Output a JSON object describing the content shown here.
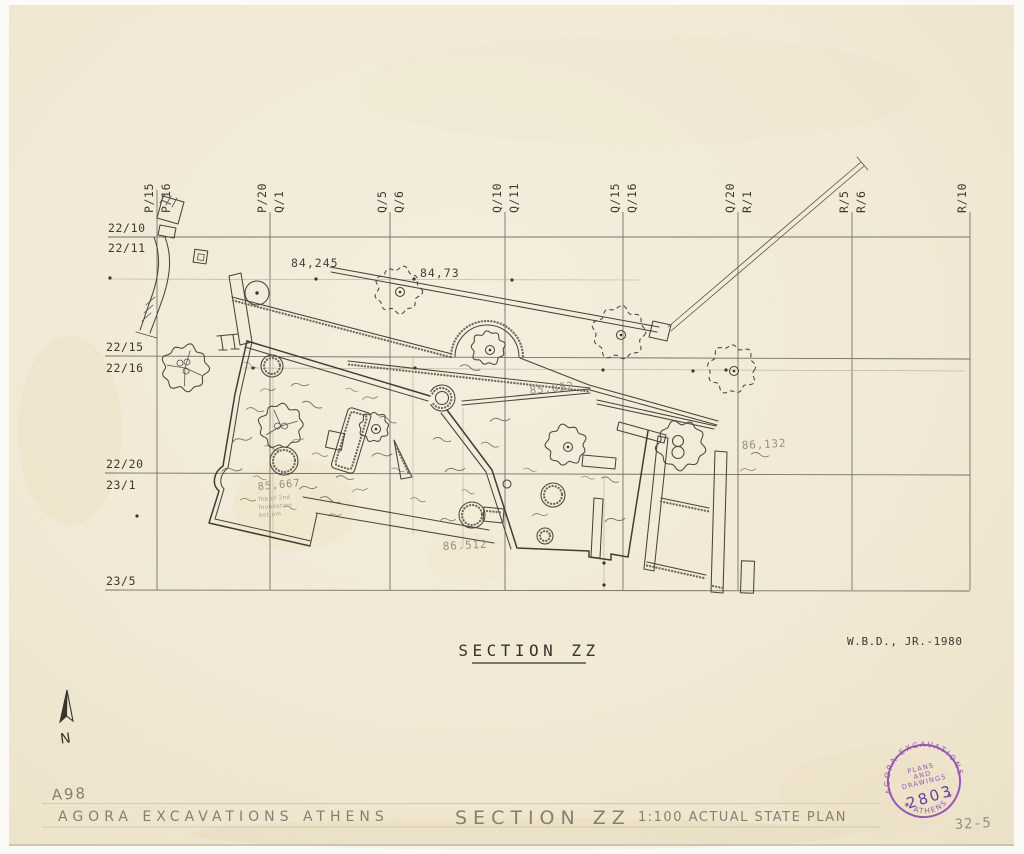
{
  "sheet": {
    "kind": "archaeological plan scan",
    "paper_color": "#f1e9d6",
    "ink_color": "#38352d",
    "pencil_color": "#97907c",
    "stamp_color": "#8d4ab2"
  },
  "grid": {
    "columns": [
      {
        "left": "P/15",
        "right": "P/16"
      },
      {
        "left": "P/20",
        "right": "Q/1"
      },
      {
        "left": "Q/5",
        "right": "Q/6"
      },
      {
        "left": "Q/10",
        "right": "Q/11"
      },
      {
        "left": "Q/15",
        "right": "Q/16"
      },
      {
        "left": "Q/20",
        "right": "R/1"
      },
      {
        "left": "R/5",
        "right": "R/6"
      },
      {
        "left": "R/10",
        "right": ""
      }
    ],
    "rows": [
      {
        "above": "22/10",
        "below": "22/11"
      },
      {
        "above": "22/15",
        "below": "22/16"
      },
      {
        "above": "22/20",
        "below": "23/1"
      },
      {
        "above": "23/5",
        "below": ""
      }
    ]
  },
  "elevations": {
    "p1": "84,245",
    "p2": "84,73",
    "p3": "85,852",
    "p4": "86,132",
    "p5": "86.512",
    "p6": "85,667",
    "note1": "Top of 2nd",
    "note2": "foundation",
    "note3": "bottom"
  },
  "title": {
    "text": "SECTION ZZ",
    "credit": "W.B.D., JR.-1980"
  },
  "compass": {
    "label": "N"
  },
  "footer": {
    "ref": "A98",
    "org": "AGORA EXCAVATIONS ATHENS",
    "section": "SECTION ZZ",
    "scale_plan": "1:100 ACTUAL STATE PLAN",
    "page": "32-5"
  },
  "stamp": {
    "top": "AGORA EXCAVATIONS",
    "bottom": "★ ATHENS ★",
    "line1": "PLANS",
    "line2": "AND",
    "line3": "DRAWINGS",
    "number": "2803"
  }
}
